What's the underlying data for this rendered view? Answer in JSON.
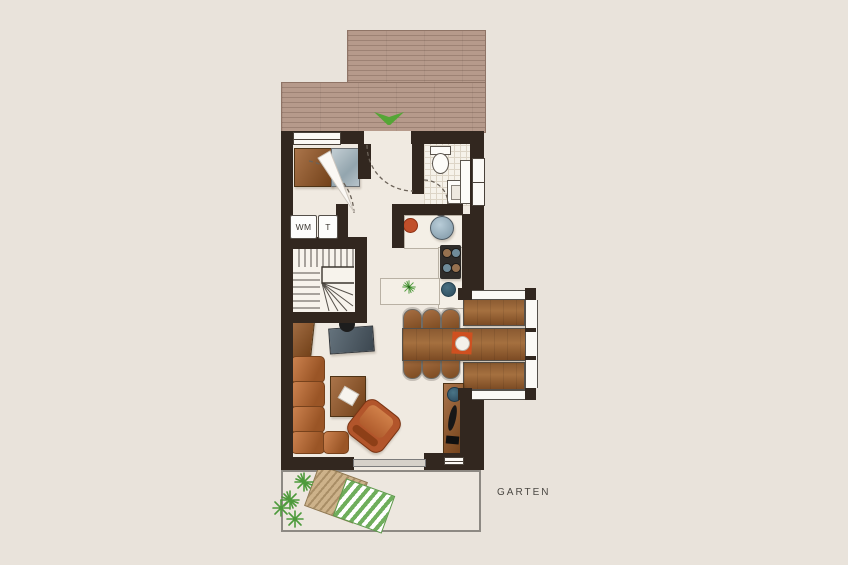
{
  "meta": {
    "type": "architectural-floor-plan",
    "view": "top-down",
    "floor": "ground-floor"
  },
  "labels": {
    "washing_machine": "WM",
    "dryer": "T",
    "garden": "GARTEN"
  },
  "palette": {
    "bg": "#e9e3db",
    "floor": "#f0eae1",
    "wall": "#32271f",
    "deck": "#b69a8b",
    "deck-line": "#9d8274",
    "wood-light": "#aa744a",
    "wood-dark": "#714018",
    "sofa-light": "#cd8350",
    "sofa-dark": "#9a5526",
    "green": "#55a636",
    "water": "#8fa6b4",
    "text": "#4b4843"
  },
  "areas": [
    "roof-deck-terrace",
    "entrance-hall",
    "wardrobe-nook",
    "utility-corner",
    "bathroom-wc",
    "kitchen",
    "winder-staircase",
    "dining-area",
    "bay-window",
    "living-room",
    "garden-terrace"
  ],
  "icons": [
    "entrance-arrow-icon",
    "door-swing-arc",
    "window-symbol",
    "wardrobe-cabinet",
    "glass-cabinet",
    "washing-machine",
    "dryer",
    "toilet",
    "hand-basin",
    "bathroom-radiator",
    "kitchen-sink",
    "stove-4-burners",
    "red-bowl",
    "blue-bowl",
    "potted-plant",
    "stair-treads",
    "office-desk",
    "desk-chair",
    "side-cabinet",
    "dining-table",
    "dining-chair",
    "bay-bench",
    "placemat-with-plate",
    "l-shaped-sofa",
    "coffee-table",
    "armchair",
    "media-sideboard",
    "sun-lounger-wood",
    "sun-lounger-striped",
    "garden-plants",
    "sliding-terrace-door"
  ]
}
